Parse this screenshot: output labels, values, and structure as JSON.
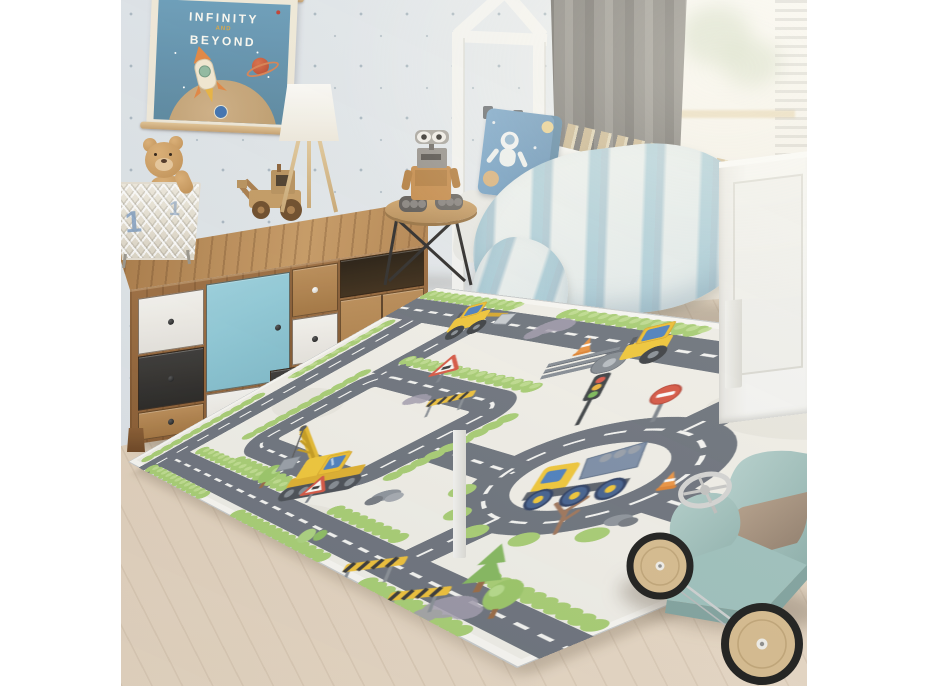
{
  "meta": {
    "canvas_w": 928,
    "canvas_h": 686,
    "kind": "product photo of a children's room",
    "page_background": "#ffffff"
  },
  "photo": {
    "offset_x": 121,
    "size": 686,
    "wall": {
      "label": "dotted wallpaper",
      "base": "#e6eaed",
      "dots": "#7d92a0"
    },
    "floor": {
      "label": "light wood floor",
      "base": "#dfcdb7",
      "plank_line": "#c5ad92"
    },
    "poster": {
      "line1": "INFINITY",
      "line2": "AND",
      "line3": "BEYOND",
      "panel_color": "#5d8dad",
      "paper_color": "#f0e9d8",
      "dowel_color": "#d7b282",
      "rocket_colors": [
        "#f2e8d2",
        "#e2833c"
      ],
      "planet_color": "#c24d2f",
      "moon_color": "#c9a97e",
      "logo": "nasa-meatball",
      "logo_color": "#3a6fae"
    },
    "dresser": {
      "label": "wooden sideboard with mixed drawers",
      "wood": "#9a6a3c",
      "wood_top": "#c89a62",
      "drawers": [
        {
          "name": "white-drawer"
        },
        {
          "name": "black-drawer"
        },
        {
          "name": "wood-panel-knob"
        },
        {
          "name": "blue-cabinet-door",
          "color": "#8fccdb"
        },
        {
          "name": "white-drawer-2"
        },
        {
          "name": "small-wood-drawer-white-knob"
        },
        {
          "name": "white-drawer-3"
        },
        {
          "name": "wide-black-drawer"
        },
        {
          "name": "open-shelf"
        },
        {
          "name": "double-wood-doors"
        }
      ]
    },
    "basket": {
      "label": "white wire storage basket",
      "numeral": "1",
      "color": "#eee9dd",
      "numeral_color": "#7d9cbf"
    },
    "teddy_bear": {
      "label": "plush teddy bear in basket",
      "fur": "#c99a60"
    },
    "toy_tractor": {
      "label": "wooden toy tractor",
      "wood": "#c49a62",
      "wheels": "#6b4a26"
    },
    "lamp": {
      "label": "tripod table lamp",
      "shade": "#f7f4ec",
      "legs": "#d8bd8e"
    },
    "side_table": {
      "label": "round wooden side table with black metal legs",
      "top": "#c99f68",
      "legs": "#2e2c2a"
    },
    "robot_toy": {
      "label": "WALL-E style robot figure",
      "body": "#c78d4c",
      "tracks": "#5f5b57",
      "eyes": "#f2efe9"
    },
    "bed": {
      "label": "white house-frame toddler bed",
      "frame": "#f3f3f0",
      "slats": "#d6c092",
      "pillow": {
        "color": "#6f9dc2",
        "print": "astronaut, stars and planets"
      },
      "duvet": {
        "colors": [
          "#eef1ee",
          "#9fc6d4",
          "#6fa3bd"
        ],
        "pattern": "watercolor stripes"
      }
    },
    "curtain": {
      "label": "gray curtain",
      "color": "#8b8884"
    },
    "window": {
      "label": "bright window with sheer light",
      "color": "#f6f4ee"
    },
    "rug": {
      "label": "construction road play rug",
      "background": "#f2f0e9",
      "road": "#6e747d",
      "road_dash": "#f7f7f4",
      "hedge": "#a9cf74",
      "vehicle_yellow": "#f2c838",
      "window_blue": "#4d80bf",
      "features": [
        "crane excavator with hook and load",
        "wheel loader",
        "road roller",
        "dump truck in roundabout",
        "roundabout",
        "road loop",
        "traffic light",
        "no-entry sign",
        "warning triangles",
        "traffic cones",
        "striped barriers",
        "steel beams",
        "rock piles",
        "trees",
        "bare tree",
        "clouds",
        "scalloped hedges"
      ]
    },
    "ride_on_car": {
      "label": "mint ride-on toy car",
      "body": "#a9c8c3",
      "seat": "#9b8877",
      "wheel_wood": "#d8bd8f",
      "tire": "#1c1c1c",
      "steering": "#d0d0d0"
    }
  }
}
